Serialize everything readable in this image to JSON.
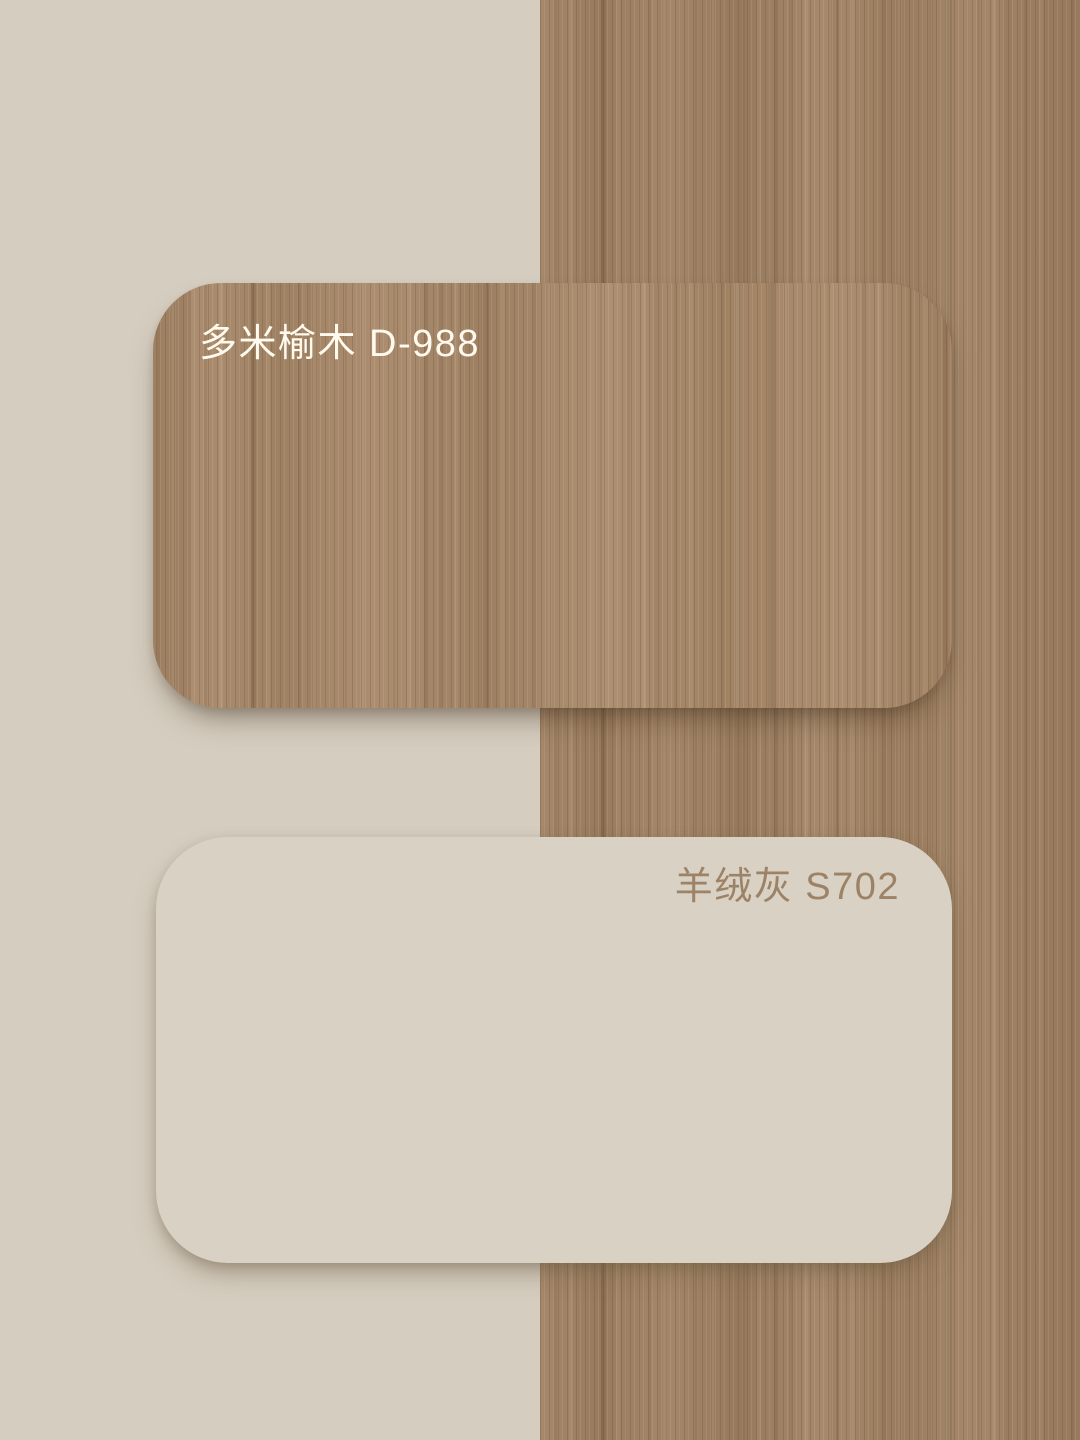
{
  "page": {
    "type": "material-swatch-board",
    "layout": "split-background-beige-left-wood-right"
  },
  "swatches": [
    {
      "label": "多米榆木 D-988",
      "name": "多米榆木",
      "code": "D-988",
      "material": "wood-grain-laminate",
      "label_color": "#f6efe3"
    },
    {
      "label": "羊绒灰 S702",
      "name": "羊绒灰",
      "code": "S702",
      "material": "solid-color-panel",
      "fill_color": "#d9d1c3",
      "label_color": "#9c8266"
    }
  ],
  "palette": {
    "beige_bg": "#d5cdbf",
    "card_beige": "#d9d1c3",
    "wood_base": "#a08162",
    "wood_dark_grain": "#7d6347",
    "wood_light_grain": "#b29374",
    "wood_label": "#f6efe3",
    "paint_label": "#9c8266"
  }
}
